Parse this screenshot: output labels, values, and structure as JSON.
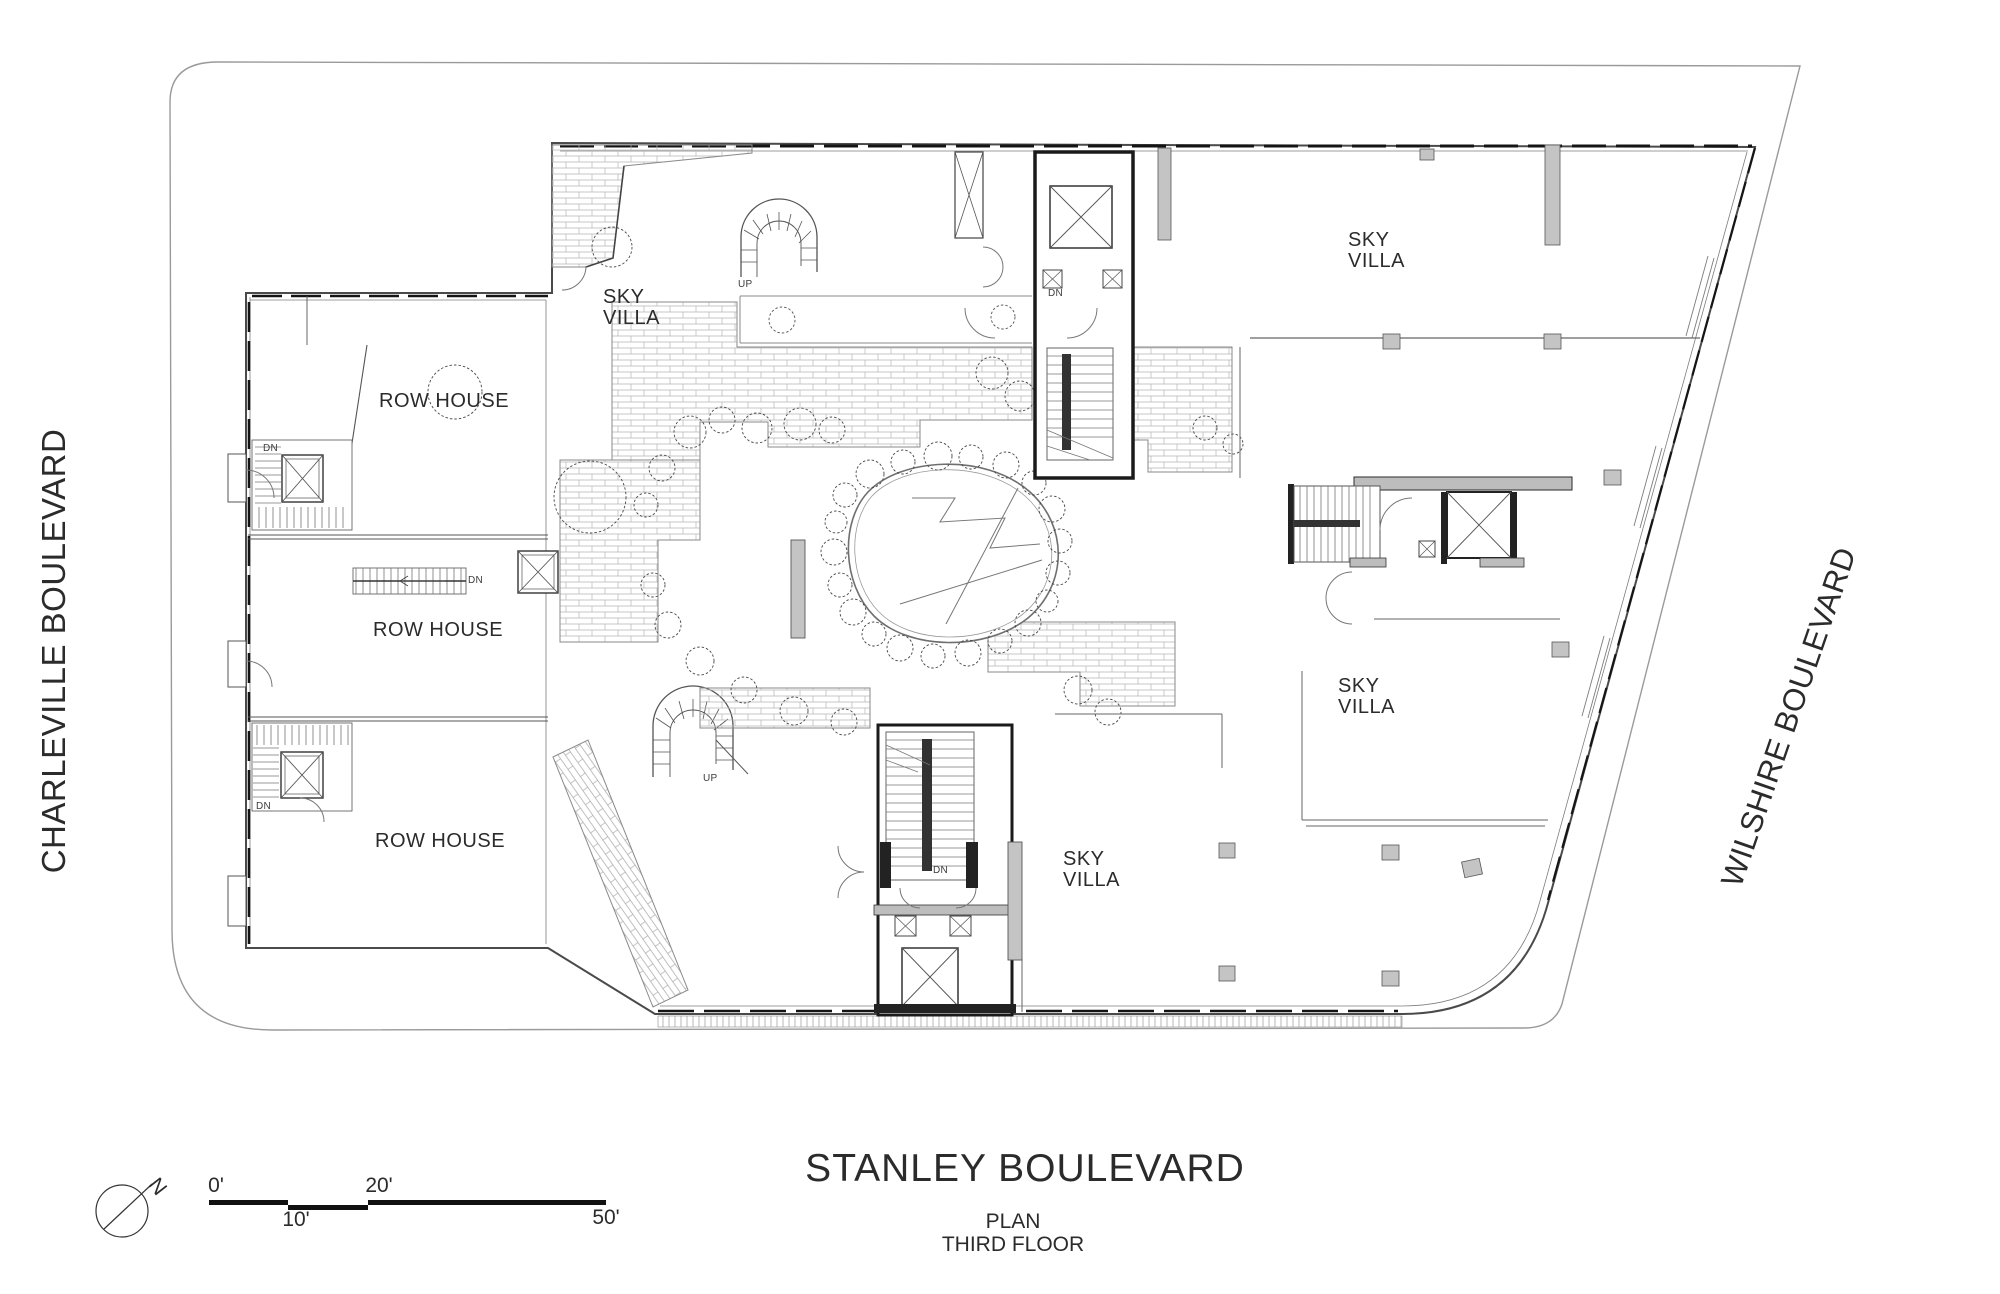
{
  "plan": {
    "line1": "PLAN",
    "line2": "THIRD FLOOR"
  },
  "streets": {
    "left": "CHARLEVILLE BOULEVARD",
    "right": "WILSHIRE BOULEVARD",
    "bottom": "STANLEY BOULEVARD"
  },
  "units": {
    "sky_villa_line1": "SKY",
    "sky_villa_line2": "VILLA",
    "row_house": "ROW HOUSE"
  },
  "stair_labels": {
    "down": "DN",
    "up": "UP"
  },
  "scale_bar": {
    "t0": "0'",
    "t10": "10'",
    "t20": "20'",
    "t50": "50'"
  },
  "north_label": "N",
  "colors": {
    "ink": "#2b2b2b",
    "wall_dark": "#1c1c1c",
    "line_gray": "#8a8a8a",
    "poche_gray": "#bdbdbd",
    "column_gray": "#c4c4c4",
    "brick_line": "#b5b5b5"
  }
}
